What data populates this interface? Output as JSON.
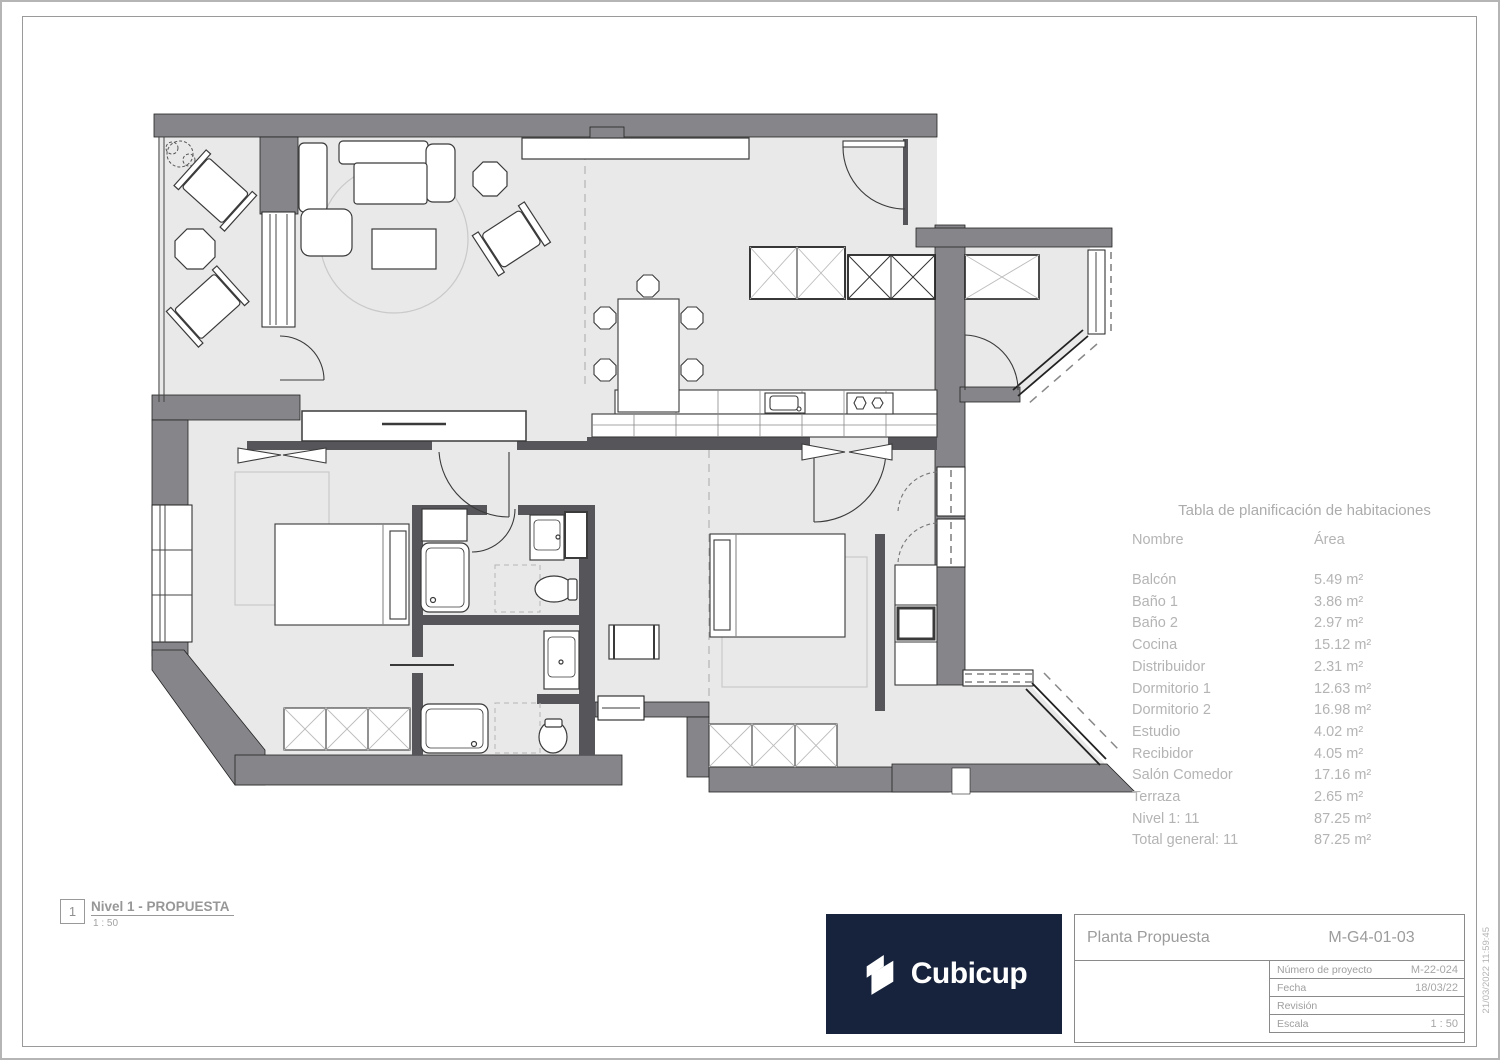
{
  "room_table": {
    "title": "Tabla de planificación de habitaciones",
    "columns": {
      "name": "Nombre",
      "area": "Área"
    },
    "rows": [
      {
        "name": "Balcón",
        "area": "5.49 m²"
      },
      {
        "name": "Baño 1",
        "area": "3.86 m²"
      },
      {
        "name": "Baño 2",
        "area": "2.97 m²"
      },
      {
        "name": "Cocina",
        "area": "15.12 m²"
      },
      {
        "name": "Distribuidor",
        "area": "2.31 m²"
      },
      {
        "name": "Dormitorio 1",
        "area": "12.63 m²"
      },
      {
        "name": "Dormitorio 2",
        "area": "16.98 m²"
      },
      {
        "name": "Estudio",
        "area": "4.02 m²"
      },
      {
        "name": "Recibidor",
        "area": "4.05 m²"
      },
      {
        "name": "Salón Comedor",
        "area": "17.16 m²"
      },
      {
        "name": "Terraza",
        "area": "2.65 m²"
      },
      {
        "name": "Nivel 1: 11",
        "area": "87.25 m²"
      },
      {
        "name": "Total general: 11",
        "area": "87.25 m²"
      }
    ]
  },
  "title_block": {
    "drawing_title": "Planta Propuesta",
    "drawing_code": "M-G4-01-03",
    "fields": [
      {
        "label": "Número de proyecto",
        "value": "M-22-024"
      },
      {
        "label": "Fecha",
        "value": "18/03/22"
      },
      {
        "label": "Revisión",
        "value": ""
      },
      {
        "label": "Escala",
        "value": "1 : 50"
      }
    ]
  },
  "view_label": {
    "number": "1",
    "title": "Nivel 1 - PROPUESTA",
    "scale": "1 : 50"
  },
  "logo": {
    "text": "Cubicup",
    "background": "#17233c"
  },
  "timestamp": "21/03/2022 11:59:45",
  "colors": {
    "wall": "#85858a",
    "wall_dark": "#55555a",
    "floor": "#e9e9ea",
    "text_gray": "#b4b4b4",
    "title_text": "#9c9c9c"
  }
}
